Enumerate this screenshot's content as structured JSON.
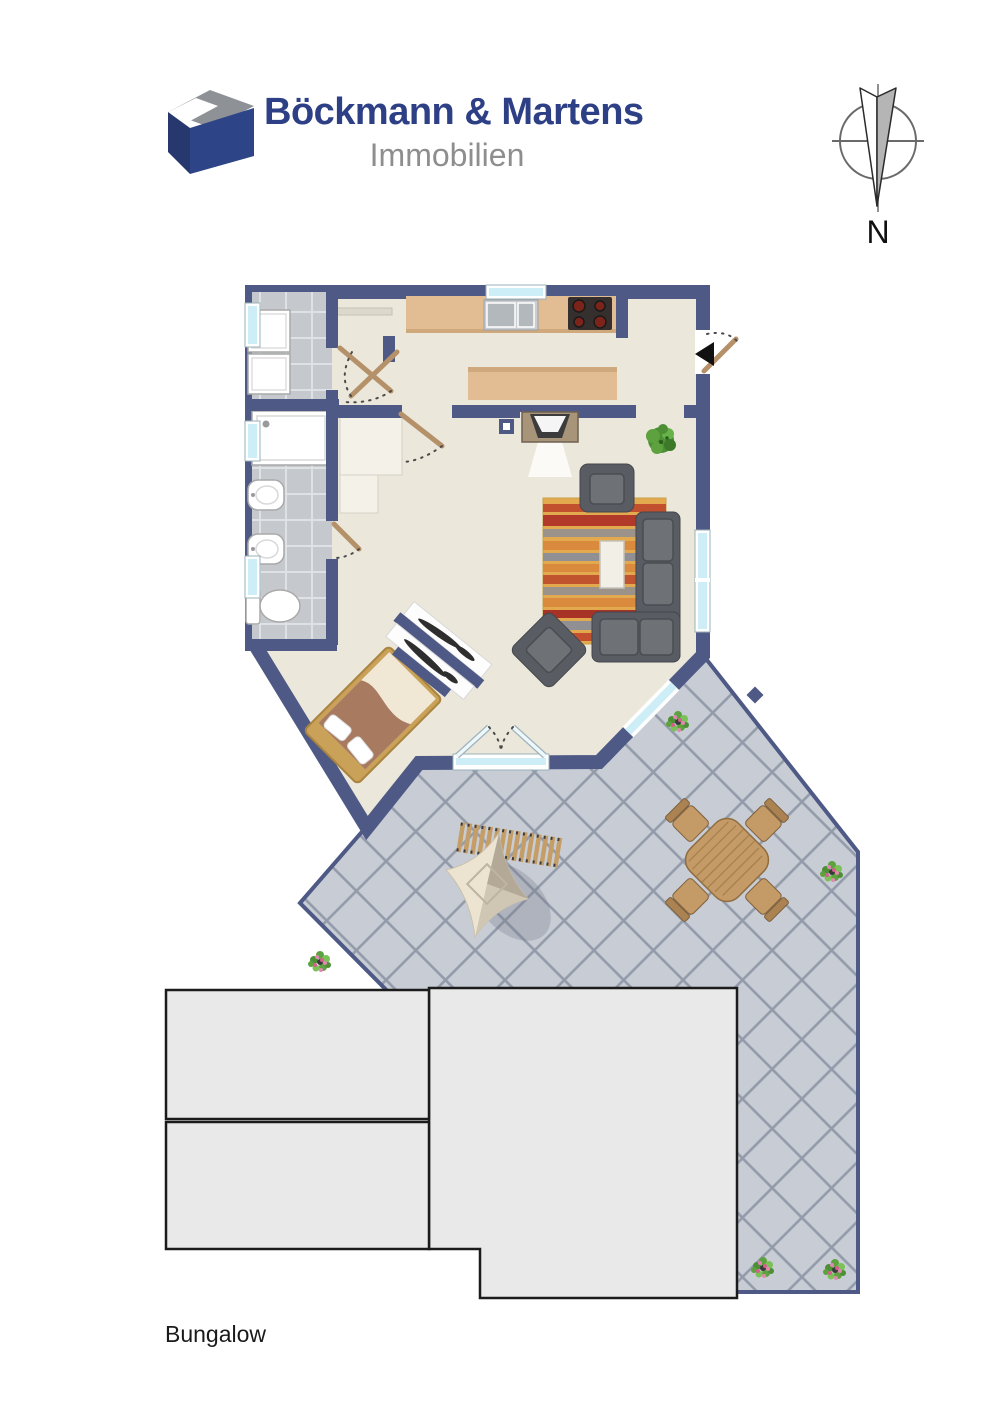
{
  "brand": {
    "name": "Böckmann & Martens",
    "division": "Immobilien"
  },
  "compass": {
    "north_label": "N"
  },
  "caption": {
    "label": "Bungalow"
  },
  "colors": {
    "wall": "#4e5a85",
    "floor": "#ebe7da",
    "room_tile": "#c5c9cd",
    "room_grout": "#dfe2e5",
    "terrace_tile": "#c8cdd5",
    "terrace_grout": "#939baa",
    "counter_wood": "#e2bc92",
    "furniture_wood": "#c49a66",
    "sofa_gray": "#595d63",
    "rug_orange": "#e2a94e",
    "building_gray": "#e9e9e9",
    "window_glass": "#cdeef6",
    "brand_blue": "#2d3f85",
    "brand_gray": "#8e8e8e"
  }
}
